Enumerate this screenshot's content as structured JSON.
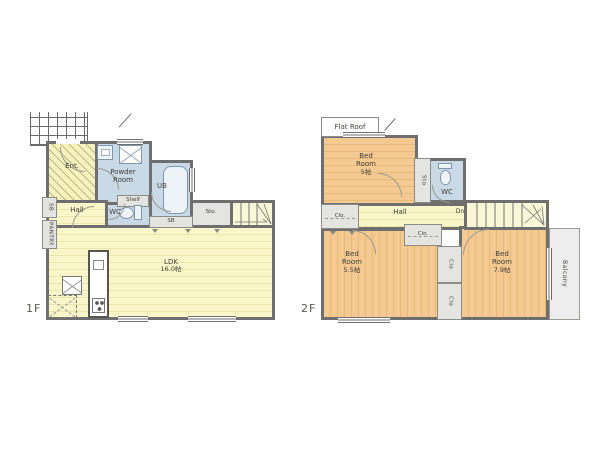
{
  "floor1": {
    "label": "1F",
    "ent": "Ent.",
    "powder_room": "Powder Room",
    "shelf": "Shelf",
    "ub": "UB",
    "wc": "WC",
    "hall": "Hall",
    "shoe_box": "SB",
    "pantry": "PANTRY",
    "bath_storage": "SB",
    "storage": "Sto.",
    "ldk_name": "LDK",
    "ldk_size": "16.0帖"
  },
  "floor2": {
    "label": "2F",
    "flat_roof": "Flat Roof",
    "bedroom1_name": "Bed Room",
    "bedroom1_size": "5帖",
    "storage": "Sto",
    "wc": "WC",
    "hall": "Hall",
    "down": "Dn",
    "closet_left": "Clo.",
    "closet_center": "Clo.",
    "closet_mid_top": "Clo",
    "closet_mid_bottom": "Clo",
    "bedroom2_name": "Bed Room",
    "bedroom2_size": "5.5帖",
    "bedroom3_name": "Bed Room",
    "bedroom3_size": "7.9帖",
    "balcony": "Balcony"
  },
  "colors": {
    "wall": "#6f6f6f",
    "room_yellow": "#f8f5c4",
    "room_orange": "#f3c88e",
    "wet_blue": "#c9d9e6",
    "closet_gray": "#e4e4e1",
    "balcony_gray": "#ededed"
  }
}
